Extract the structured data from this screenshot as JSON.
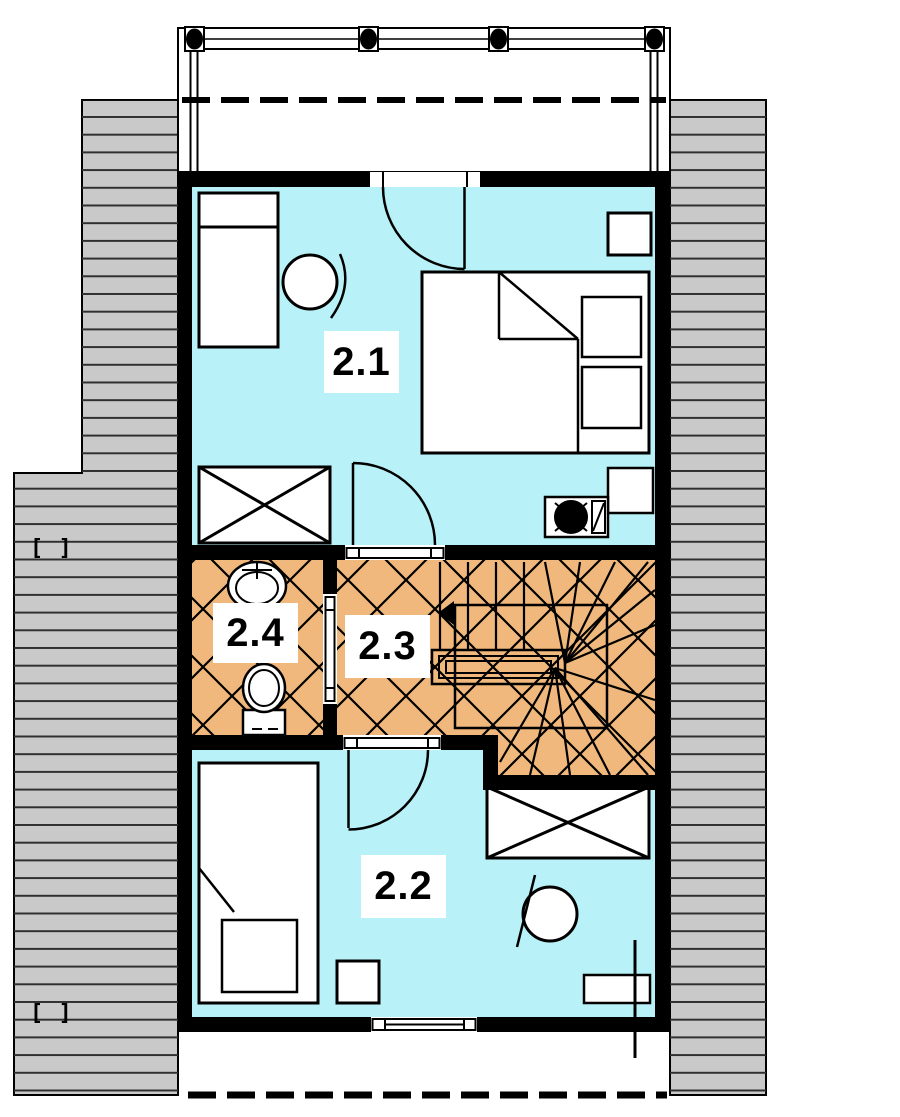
{
  "labels": {
    "room_2_1": "2.1",
    "room_2_2": "2.2",
    "room_2_3": "2.3",
    "room_2_4": "2.4",
    "left_marker_upper": "[ ]",
    "left_marker_lower": "[ ]"
  },
  "colors": {
    "room_fill_cyan": "#b8f2f8",
    "room_fill_orange": "#f0b87c",
    "roof_fill_gray": "#c9c9c9",
    "wall_black": "#000000",
    "background": "#ffffff"
  }
}
